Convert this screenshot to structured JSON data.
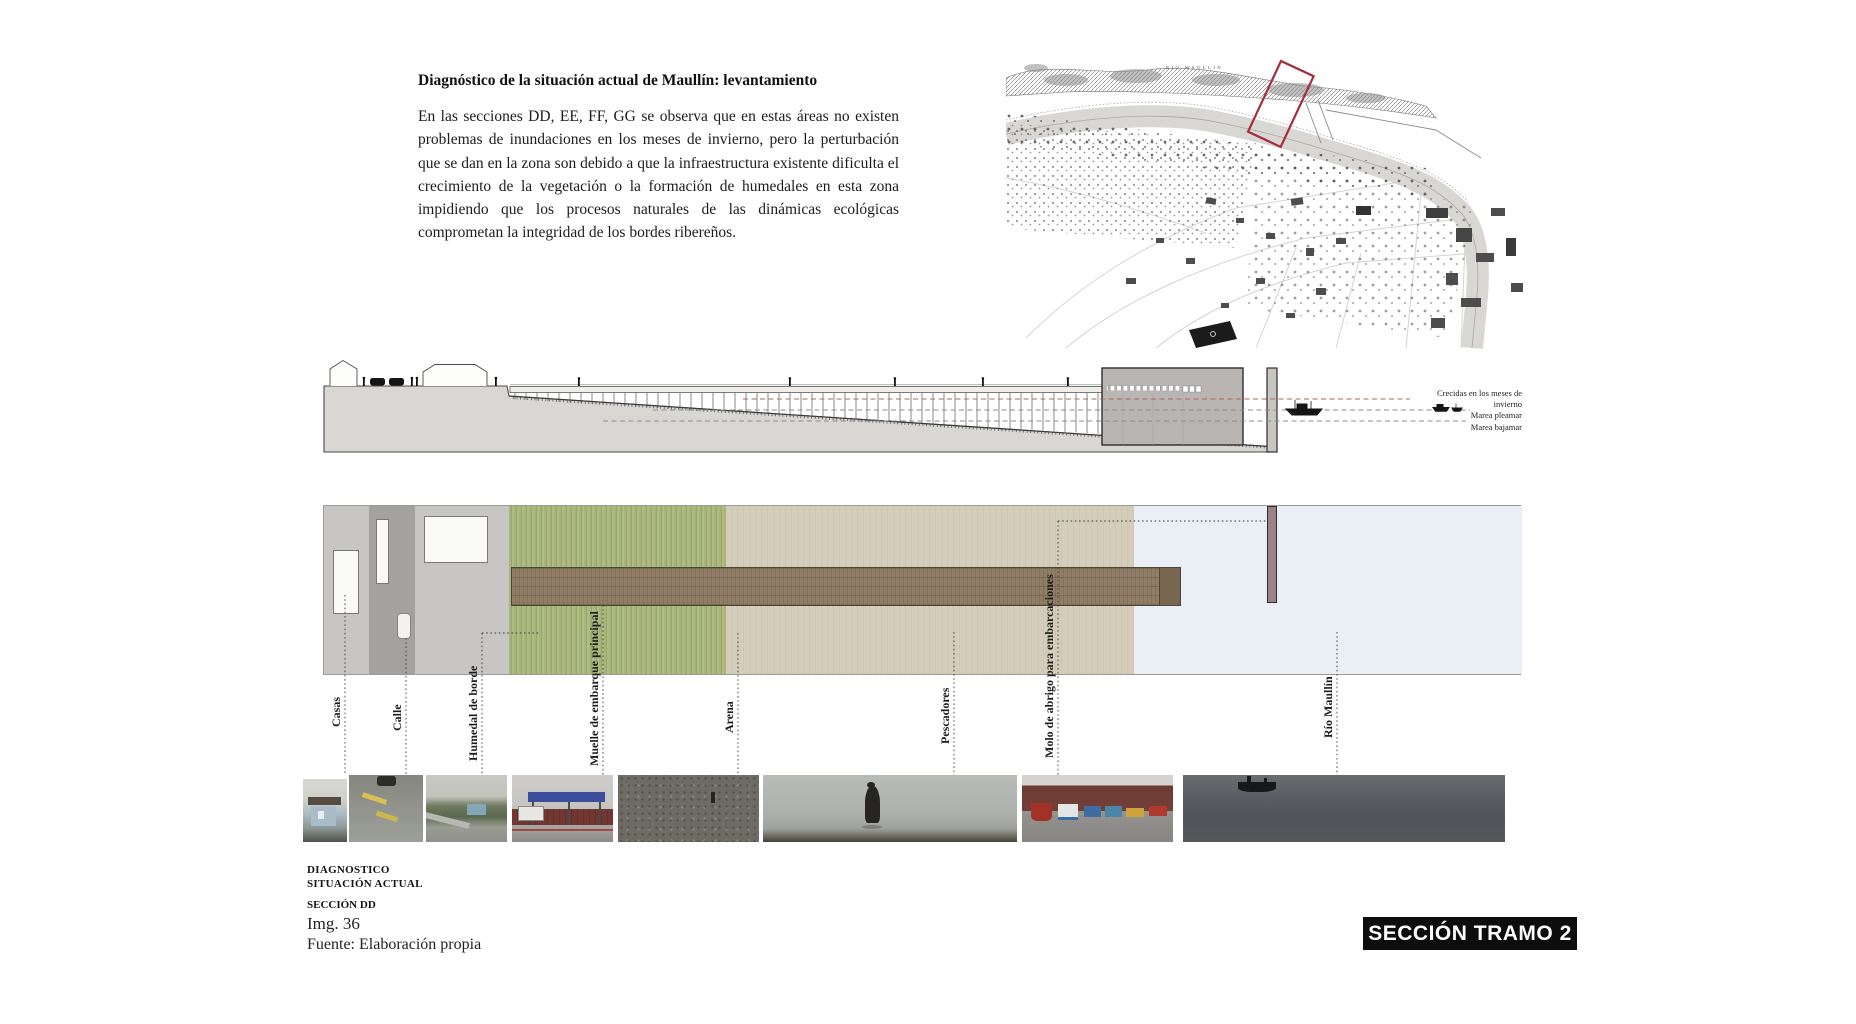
{
  "header": {
    "title": "Diagnóstico de la situación actual de Maullín: levantamiento",
    "paragraph": "En las secciones DD, EE, FF, GG se observa que en estas áreas no existen problemas de inundaciones en los meses de invierno, pero la perturbación que se dan en la zona son debido a que la infraestructura existente dificulta el crecimiento de la vegetación o la formación de humedales en esta zona impidiendo que los procesos naturales de las dinámicas ecológicas comprometan la integridad de los bordes ribereños."
  },
  "map": {
    "river_label": "RIO MAULLIN",
    "marker_color": "#a32c3e"
  },
  "elevation": {
    "tide_labels": [
      "Crecidas en los meses de invierno",
      "Marea pleamar",
      "Marea bajamar"
    ]
  },
  "plan": {
    "labels": [
      "Casas",
      "Calle",
      "Humedal de borde",
      "Muelle de embarque principal",
      "Arena",
      "Pescadores",
      "Molo de abrigo para embarcaciones",
      "Río Maullín"
    ],
    "colors": {
      "wetland_green": "#a7b57a",
      "sand_tan": "#d1cab6",
      "water_blue": "#e9eff5",
      "pier_brown": "#8f7d66",
      "breakwater_mauve": "#9c8185"
    }
  },
  "footer": {
    "category_line1": "DIAGNOSTICO",
    "category_line2": "SITUACIÓN ACTUAL",
    "section_label": "SECCIÓN DD",
    "image_number": "Img. 36",
    "source": "Fuente: Elaboración propia"
  },
  "badge": {
    "label": "SECCIÓN TRAMO 2"
  }
}
